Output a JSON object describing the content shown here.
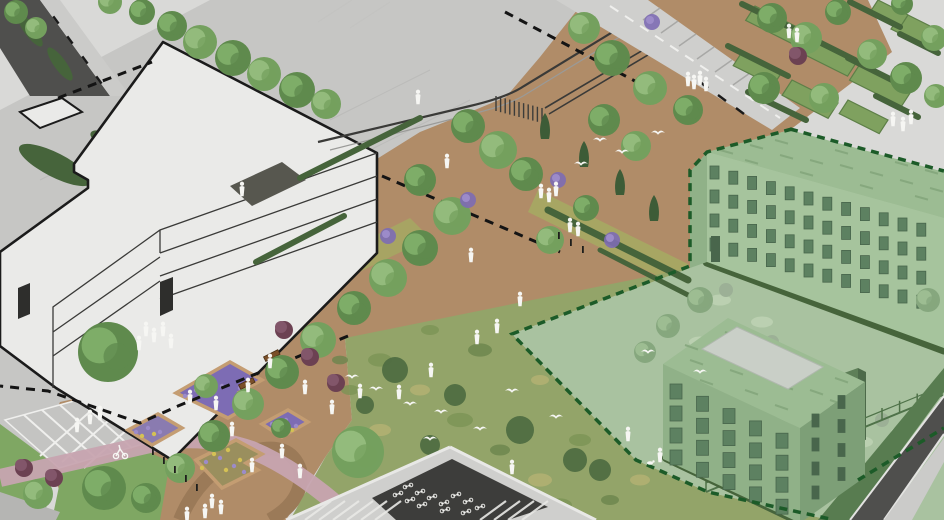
{
  "meta": {
    "kind": "axonometric-landscape-site-rendering",
    "title": ""
  },
  "palette": {
    "bg": "#d9d9d7",
    "plaza": "#c6c6c4",
    "paver_line": "#b2b2b0",
    "sidewalk": "#cbcbc9",
    "asphalt": "#4f4f4d",
    "road_light": "#cfcfcd",
    "curb": "#e3e3e1",
    "mulch": "#b08c68",
    "mulch_dark": "#9b7a58",
    "lawn": "#7fa763",
    "meadow": "#93a469",
    "meadow_dark": "#4d6a40",
    "hedge": "#46643b",
    "conifer": "#3d5c37",
    "shrub_red": "#6c4152",
    "shrub_red_light": "#82566a",
    "flower_purple": "#7d6cb4",
    "flower_purple_light": "#9c8bc9",
    "flower_yellow": "#d4c154",
    "planter_edge": "#c49d72",
    "pink": "#c7a4b0",
    "white": "#f6f6f3",
    "bldg_white": "#eaeae8",
    "bldg_stroke": "#1b1b1b",
    "line_dark": "#3a3a38",
    "line_light": "#9a9a98",
    "door": "#2e2e2c",
    "dark_bed": "#57574f",
    "tint_ground": "#a9c2a0",
    "tint_blob": "#bdd1b3",
    "tint_gray": "#9cb096",
    "gwall": "#a6c49d",
    "gwall_shade": "#90b188",
    "gwall_dark": "#7d9f77",
    "gwin": "#5d8161",
    "gwin_dark": "#49664c",
    "groof": "#9cbc93",
    "gstreak": "#83a57b",
    "skylight": "#c9cfc7",
    "base_hedge": "#587c50",
    "bndry_green": "#1c5b28",
    "bndry_black": "#141414",
    "fence": "#4f7249",
    "shed": "#5e7f58",
    "shed_dark": "#4d6a4a",
    "bike_dark": "#3d3d3b",
    "frame_light": "#e8e8e6",
    "plot_green": "#7fa15f",
    "plot_stroke": "#5d7f47",
    "bench": "#7a4f28",
    "wildflower": "#a6a863",
    "wall_gray": "#b5b5b3",
    "tree": {
      "l": [
        "#74a05e",
        "#93bb7c"
      ],
      "m": [
        "#5f8a4d",
        "#7ead68"
      ],
      "t": [
        "#86a77e",
        "#9dbd92"
      ]
    },
    "mottle": {
      "a": "#7c9455",
      "b": "#b5b273",
      "c": "#6b854c"
    }
  },
  "scene": {
    "trees": [
      [
        172,
        26,
        15,
        "m"
      ],
      [
        200,
        42,
        17,
        "l"
      ],
      [
        233,
        58,
        18,
        "m"
      ],
      [
        264,
        74,
        17,
        "l"
      ],
      [
        297,
        90,
        18,
        "m"
      ],
      [
        326,
        104,
        15,
        "l"
      ],
      [
        142,
        12,
        13,
        "m"
      ],
      [
        110,
        2,
        12,
        "l"
      ],
      [
        16,
        12,
        12,
        "m"
      ],
      [
        36,
        28,
        11,
        "l"
      ],
      [
        468,
        126,
        17,
        "m"
      ],
      [
        498,
        150,
        19,
        "l"
      ],
      [
        526,
        174,
        17,
        "m"
      ],
      [
        452,
        216,
        19,
        "l"
      ],
      [
        420,
        248,
        18,
        "m"
      ],
      [
        388,
        278,
        19,
        "l"
      ],
      [
        354,
        308,
        17,
        "m"
      ],
      [
        318,
        340,
        18,
        "l"
      ],
      [
        282,
        372,
        17,
        "m"
      ],
      [
        248,
        404,
        16,
        "l"
      ],
      [
        214,
        436,
        16,
        "m"
      ],
      [
        180,
        468,
        15,
        "l"
      ],
      [
        146,
        498,
        15,
        "m"
      ],
      [
        420,
        180,
        16,
        "m"
      ],
      [
        604,
        120,
        16,
        "m"
      ],
      [
        636,
        146,
        15,
        "l"
      ],
      [
        586,
        208,
        13,
        "m"
      ],
      [
        550,
        240,
        14,
        "l"
      ],
      [
        612,
        58,
        18,
        "m"
      ],
      [
        650,
        88,
        17,
        "l"
      ],
      [
        688,
        110,
        15,
        "m"
      ],
      [
        584,
        28,
        16,
        "l"
      ],
      [
        358,
        452,
        26,
        "l"
      ],
      [
        108,
        352,
        30,
        "m"
      ],
      [
        104,
        488,
        22,
        "m"
      ],
      [
        38,
        494,
        15,
        "l"
      ],
      [
        206,
        386,
        12,
        "l"
      ],
      [
        281,
        428,
        10,
        "m"
      ],
      [
        772,
        18,
        15,
        "m"
      ],
      [
        806,
        38,
        16,
        "l"
      ],
      [
        838,
        12,
        13,
        "m"
      ],
      [
        872,
        54,
        15,
        "l"
      ],
      [
        906,
        78,
        16,
        "m"
      ],
      [
        934,
        38,
        13,
        "l"
      ],
      [
        764,
        88,
        16,
        "m"
      ],
      [
        824,
        98,
        15,
        "l"
      ],
      [
        902,
        4,
        11,
        "m"
      ],
      [
        936,
        96,
        12,
        "l"
      ],
      [
        700,
        300,
        13,
        "t"
      ],
      [
        668,
        326,
        12,
        "t"
      ],
      [
        645,
        352,
        11,
        "t"
      ],
      [
        928,
        300,
        12,
        "t"
      ]
    ],
    "conifers": [
      [
        584,
        156
      ],
      [
        620,
        184
      ],
      [
        654,
        210
      ],
      [
        545,
        128
      ]
    ],
    "shrubs_red": [
      [
        284,
        330
      ],
      [
        310,
        357
      ],
      [
        336,
        383
      ],
      [
        24,
        468
      ],
      [
        54,
        478
      ],
      [
        798,
        56
      ]
    ],
    "flower_clumps": [
      [
        652,
        22
      ],
      [
        558,
        180
      ],
      [
        468,
        200
      ],
      [
        612,
        240
      ],
      [
        388,
        236
      ]
    ],
    "people": [
      [
        418,
        98
      ],
      [
        447,
        162
      ],
      [
        541,
        192
      ],
      [
        549,
        196
      ],
      [
        556,
        190
      ],
      [
        570,
        226
      ],
      [
        578,
        230
      ],
      [
        471,
        256
      ],
      [
        520,
        300
      ],
      [
        497,
        327
      ],
      [
        477,
        338
      ],
      [
        431,
        371
      ],
      [
        399,
        393
      ],
      [
        146,
        330
      ],
      [
        154,
        336
      ],
      [
        163,
        330
      ],
      [
        171,
        342
      ],
      [
        139,
        344
      ],
      [
        90,
        418
      ],
      [
        100,
        414
      ],
      [
        77,
        426
      ],
      [
        789,
        32
      ],
      [
        797,
        36
      ],
      [
        688,
        80
      ],
      [
        694,
        83
      ],
      [
        700,
        79
      ],
      [
        706,
        85
      ],
      [
        893,
        120
      ],
      [
        903,
        125
      ],
      [
        911,
        118
      ],
      [
        190,
        398
      ],
      [
        216,
        404
      ],
      [
        232,
        430
      ],
      [
        252,
        466
      ],
      [
        282,
        452
      ],
      [
        305,
        388
      ],
      [
        332,
        408
      ],
      [
        360,
        392
      ],
      [
        248,
        386
      ],
      [
        270,
        362
      ],
      [
        212,
        502
      ],
      [
        221,
        508
      ],
      [
        205,
        512
      ],
      [
        187,
        515
      ],
      [
        628,
        435
      ],
      [
        512,
        468
      ],
      [
        660,
        456
      ],
      [
        242,
        190
      ],
      [
        300,
        472
      ]
    ],
    "birds": [
      [
        600,
        140
      ],
      [
        622,
        152
      ],
      [
        658,
        133
      ],
      [
        581,
        164
      ],
      [
        376,
        389
      ],
      [
        410,
        404
      ],
      [
        441,
        412
      ],
      [
        480,
        429
      ],
      [
        430,
        439
      ],
      [
        512,
        391
      ],
      [
        556,
        417
      ],
      [
        352,
        377
      ],
      [
        648,
        352
      ],
      [
        700,
        372
      ]
    ],
    "bollards": [
      [
        152,
        448
      ],
      [
        163,
        457
      ],
      [
        174,
        466
      ],
      [
        185,
        475
      ],
      [
        196,
        484
      ],
      [
        558,
        232
      ],
      [
        570,
        239
      ],
      [
        582,
        246
      ]
    ],
    "plots": [
      [
        755,
        6,
        48,
        17
      ],
      [
        806,
        34,
        52,
        19
      ],
      [
        860,
        64,
        52,
        19
      ],
      [
        742,
        52,
        40,
        16
      ],
      [
        792,
        80,
        46,
        18
      ],
      [
        848,
        100,
        40,
        16
      ],
      [
        902,
        12,
        34,
        20
      ],
      [
        878,
        0,
        30,
        12
      ]
    ],
    "hedges": [
      [
        742,
        4,
        800,
        32,
        6
      ],
      [
        795,
        30,
        855,
        60,
        6
      ],
      [
        848,
        58,
        908,
        88,
        6
      ],
      [
        728,
        46,
        788,
        76,
        6
      ],
      [
        850,
        2,
        900,
        27,
        6
      ],
      [
        900,
        34,
        938,
        53,
        6
      ],
      [
        748,
        92,
        806,
        120,
        6
      ],
      [
        876,
        96,
        918,
        117,
        6
      ],
      [
        548,
        210,
        688,
        280,
        7
      ],
      [
        300,
        178,
        420,
        118,
        6
      ],
      [
        256,
        262,
        344,
        216,
        6
      ],
      [
        600,
        250,
        688,
        295,
        5
      ],
      [
        666,
        458,
        800,
        522,
        8
      ],
      [
        707,
        262,
        944,
        350,
        9
      ]
    ],
    "mottles": [
      [
        380,
        360,
        12,
        "a"
      ],
      [
        420,
        390,
        10,
        "b"
      ],
      [
        460,
        420,
        13,
        "a"
      ],
      [
        500,
        450,
        10,
        "c"
      ],
      [
        540,
        480,
        12,
        "b"
      ],
      [
        580,
        440,
        11,
        "a"
      ],
      [
        540,
        380,
        9,
        "b"
      ],
      [
        480,
        350,
        12,
        "c"
      ],
      [
        430,
        330,
        9,
        "a"
      ],
      [
        560,
        350,
        10,
        "b"
      ],
      [
        610,
        330,
        9,
        "c"
      ],
      [
        600,
        390,
        12,
        "a"
      ],
      [
        640,
        420,
        10,
        "b"
      ],
      [
        660,
        390,
        9,
        "c"
      ],
      [
        380,
        430,
        11,
        "b"
      ],
      [
        350,
        390,
        9,
        "a"
      ],
      [
        420,
        470,
        12,
        "c"
      ],
      [
        470,
        500,
        11,
        "b"
      ],
      [
        560,
        505,
        12,
        "a"
      ],
      [
        640,
        480,
        10,
        "b"
      ],
      [
        610,
        500,
        9,
        "c"
      ],
      [
        688,
        310,
        9,
        "a"
      ],
      [
        650,
        300,
        8,
        "b"
      ],
      [
        390,
        500,
        10,
        "a"
      ],
      [
        340,
        360,
        8,
        "c"
      ]
    ],
    "meadow_shrubs": [
      [
        395,
        370,
        13
      ],
      [
        455,
        395,
        11
      ],
      [
        520,
        430,
        14
      ],
      [
        575,
        460,
        12
      ],
      [
        610,
        360,
        10
      ],
      [
        650,
        440,
        13
      ],
      [
        430,
        445,
        10
      ],
      [
        365,
        405,
        9
      ],
      [
        600,
        470,
        11
      ]
    ],
    "tint_blobs": [
      [
        720,
        300
      ],
      [
        762,
        322
      ],
      [
        700,
        342
      ],
      [
        745,
        362
      ],
      [
        800,
        382
      ],
      [
        842,
        402
      ],
      [
        782,
        422
      ],
      [
        862,
        442
      ],
      [
        902,
        432
      ],
      [
        920,
        472
      ],
      [
        822,
        472
      ],
      [
        752,
        452
      ],
      [
        880,
        470
      ],
      [
        905,
        500
      ]
    ],
    "tint_gray_dots": [
      [
        726,
        290
      ],
      [
        772,
        342
      ],
      [
        882,
        420
      ]
    ],
    "streaks_b1": [
      [
        720,
        150
      ],
      [
        750,
        145
      ],
      [
        780,
        155
      ],
      [
        810,
        160
      ],
      [
        840,
        165
      ],
      [
        870,
        172
      ],
      [
        900,
        180
      ],
      [
        930,
        188
      ],
      [
        745,
        160
      ],
      [
        800,
        172
      ],
      [
        860,
        185
      ],
      [
        915,
        196
      ],
      [
        775,
        140
      ],
      [
        835,
        150
      ],
      [
        895,
        162
      ],
      [
        925,
        170
      ]
    ],
    "streaks_b2": [
      [
        690,
        360
      ],
      [
        710,
        345
      ],
      [
        730,
        370
      ],
      [
        760,
        365
      ],
      [
        780,
        385
      ],
      [
        810,
        390
      ],
      [
        830,
        400
      ],
      [
        700,
        380
      ],
      [
        745,
        390
      ],
      [
        775,
        405
      ],
      [
        685,
        345
      ],
      [
        725,
        332
      ],
      [
        765,
        345
      ],
      [
        805,
        362
      ],
      [
        835,
        378
      ]
    ],
    "win_b1": {
      "x": 710,
      "y": 154,
      "cols": 12,
      "dx": 18.8,
      "dy": 5.2,
      "rows": [
        12,
        36,
        60,
        84
      ],
      "w": 9,
      "h": 13
    },
    "win_b2": {
      "x": 670,
      "y": 376,
      "cols": 5,
      "dx": 26.5,
      "dy": 12.3,
      "rows": [
        8,
        30,
        52,
        74
      ],
      "w": 12,
      "h": 15
    },
    "win_b2_end": {
      "x": 812,
      "y": 414,
      "cols": 2,
      "dx": 26,
      "dy": -18.5,
      "rows": [
        0,
        24,
        48,
        72
      ],
      "w": 7,
      "h": 13
    },
    "bikes": [
      [
        408,
        486
      ],
      [
        420,
        492
      ],
      [
        432,
        497
      ],
      [
        444,
        503
      ],
      [
        398,
        494
      ],
      [
        410,
        500
      ],
      [
        422,
        505
      ],
      [
        456,
        495
      ],
      [
        468,
        501
      ],
      [
        480,
        507
      ],
      [
        445,
        510
      ],
      [
        466,
        512
      ]
    ],
    "planter_purple_dots": [
      [
        185,
        396
      ],
      [
        196,
        390
      ],
      [
        210,
        394
      ],
      [
        222,
        386
      ],
      [
        240,
        388
      ],
      [
        250,
        398
      ],
      [
        136,
        432
      ],
      [
        148,
        428
      ],
      [
        160,
        432
      ],
      [
        272,
        424
      ],
      [
        286,
        420
      ],
      [
        296,
        426
      ],
      [
        206,
        462
      ],
      [
        220,
        458
      ],
      [
        234,
        466
      ],
      [
        244,
        472
      ]
    ],
    "planter_yellow_dots": [
      [
        214,
        454
      ],
      [
        228,
        450
      ],
      [
        240,
        460
      ],
      [
        252,
        464
      ],
      [
        142,
        436
      ],
      [
        154,
        434
      ],
      [
        280,
        428
      ],
      [
        292,
        430
      ],
      [
        202,
        468
      ],
      [
        226,
        470
      ]
    ]
  }
}
